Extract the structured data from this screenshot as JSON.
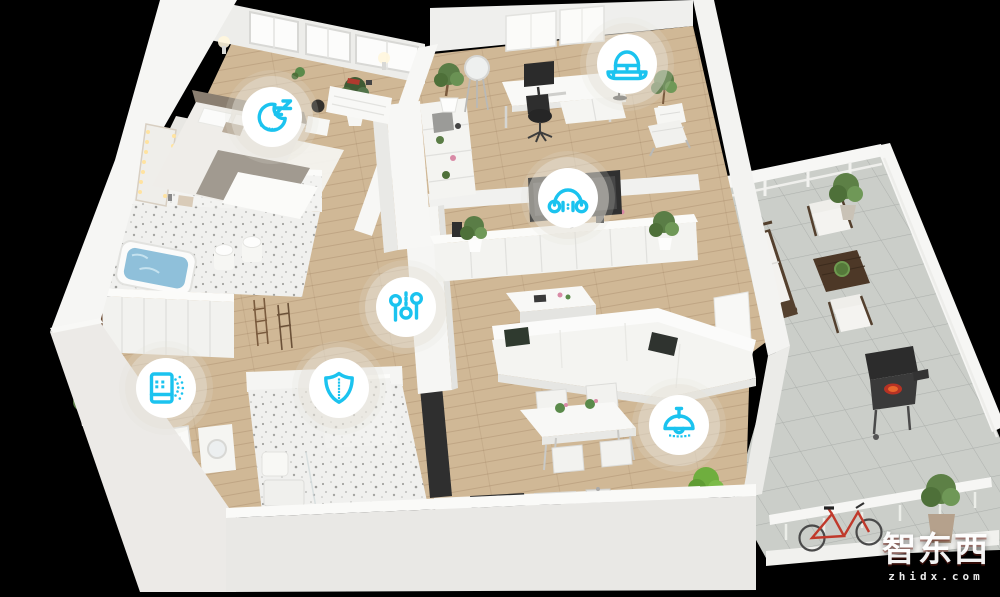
{
  "scene": {
    "kind": "3d-isometric-smart-home-floorplan",
    "background_color": "#000000"
  },
  "colors": {
    "accent": "#1BC3EF",
    "badge_fill": "#FFFFFF",
    "halo": "#E6E2DA",
    "wood_floor": "#D0B896",
    "tile_floor": "#CBCEC9",
    "terrazzo_floor": "#F0F0EE",
    "wall": "#F4F4F2",
    "bathtub_water": "#8FC0DA",
    "bicycle": "#C0392B",
    "grill_glow": "#E8662C"
  },
  "hotspots": [
    {
      "icon": "moon-zz-sleep-icon"
    },
    {
      "icon": "hat-icon"
    },
    {
      "icon": "headphones-icon"
    },
    {
      "icon": "control-sliders-icon"
    },
    {
      "icon": "shield-security-icon"
    },
    {
      "icon": "air-purifier-icon"
    },
    {
      "icon": "pendant-lamp-icon"
    }
  ],
  "watermark": {
    "brand_text": "智东西",
    "domain_text": "zhidx.com"
  }
}
